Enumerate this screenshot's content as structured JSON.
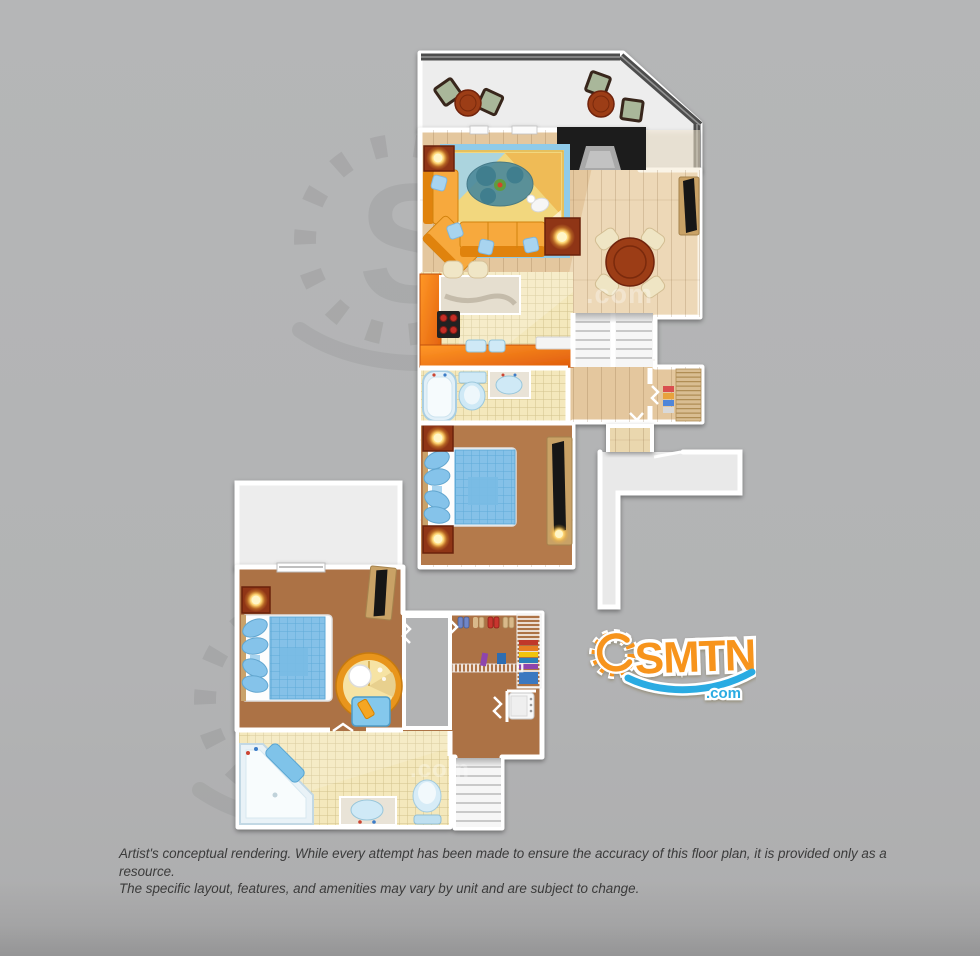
{
  "canvas": {
    "width": 980,
    "height": 956,
    "background": "#b2b3b4"
  },
  "logo": {
    "name": "SMTN",
    "tld": ".com",
    "orange": "#F7941E",
    "blue": "#29ABE2",
    "outline": "#FFFFFF"
  },
  "watermark": {
    "letter": "S",
    "tld": ".com"
  },
  "disclaimer": {
    "line1": "Artist's conceptual rendering. While every attempt has been made to ensure the accuracy of this floor plan, it is provided only as a resource.",
    "line2": "The specific layout, features, and amenities may vary by unit and are subject to change.",
    "color": "#3b3b3b"
  },
  "palette": {
    "wall": "#ffffff",
    "wood_floor": "#e4c79e",
    "wood_floor_light": "#f4e6c6",
    "tile_floor": "#f4e8bc",
    "carpet": "#b1784a",
    "patio_floor": "#ededed",
    "railing": "#4e4e4e",
    "counter_orange": "#f07a18",
    "sofa_orange": "#f7a93c",
    "bed_blue": "#85c1e8",
    "fixture_blue": "#cfe9f6",
    "table_wood": "#9c3c14",
    "lamp_glow": "#ffd978"
  }
}
